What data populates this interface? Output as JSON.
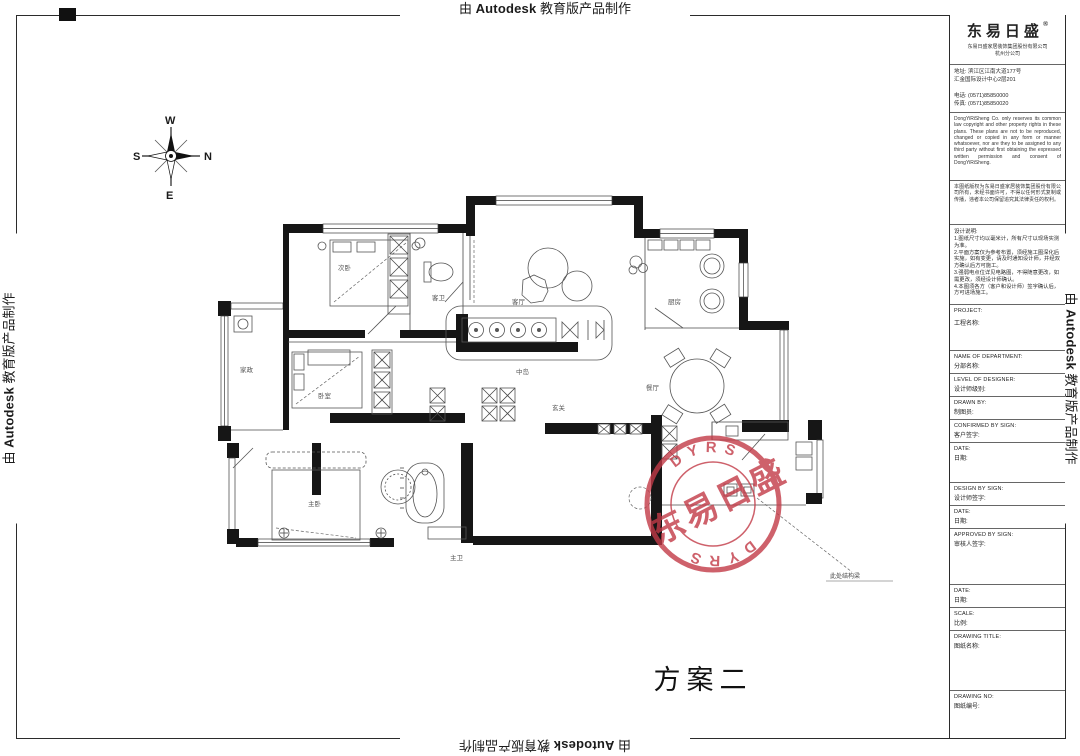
{
  "banner": {
    "prefix": "由 ",
    "brand": "Autodesk",
    "suffix": " 教育版产品制作"
  },
  "sheet_title": "方案二",
  "beam_note": "此处结构梁",
  "compass": {
    "w": "W",
    "n": "N",
    "e": "E",
    "s": "S"
  },
  "stamp": {
    "arc_top": "DYRS",
    "arc_bottom": "DYRS",
    "band": "东易日盛",
    "color": "#c23a47"
  },
  "rooms": {
    "bedroom2": "次卧",
    "bath2": "客卫",
    "living": "客厅",
    "island": "中岛",
    "kitchen": "厨房",
    "dining": "餐厅",
    "foyer": "玄关",
    "bedroom3": "卧室",
    "utility": "家政",
    "master": "主卧",
    "master_bath": "主卫"
  },
  "titleblock": {
    "logo": {
      "name": "东易日盛",
      "reg": "®",
      "company1": "东易日盛家居装饰集团股份有限公司",
      "company2": "杭州分公司"
    },
    "contact": {
      "addr1": "地址: 滨江区江南大道177号",
      "addr2": "汇金国际设计中心2层201",
      "tel": "电话: (0571)85850000",
      "fax": "传真: (0571)85850020"
    },
    "copyright_en": "DongYiRiSheng Co. only reserves its common law copyright and other property rights in these plans. These plans are not to be reproduced, changed or copied in any form or manner whatsoever, nor are they to be assigned to any third party without first obtaining the expressed written permission and consent of DongYiRiSheng.",
    "copyright_cn": "本图纸版权为东易日盛家居装饰集团股份有限公司所有，未经书面许可，不得以任何形式复制或传播，违者本公司保留追究其法律责任的权利。",
    "notes_title": "设计说明:",
    "notes": "1.图纸尺寸均以毫米计，所有尺寸以现场实测为准。\n2.平面方案仅为参考布置，须经施工图深化后实施，如有变更，请及时通知设计师，并经双方确认后方可施工。\n3.强弱电点位详见电路图，不得随意更改，如需更改，须经设计师确认。\n4.本图须各方（客户和设计师）签字确认后，方可进场施工。",
    "fields": {
      "project": {
        "en": "PROJECT:",
        "cn": "工程名称:"
      },
      "department": {
        "en": "NAME OF DEPARTMENT:",
        "cn": "分部名称:"
      },
      "level": {
        "en": "LEVEL OF DESIGNER:",
        "cn": "设计师级别:"
      },
      "drawn": {
        "en": "DRAWN BY:",
        "cn": "制图员:"
      },
      "confirmed": {
        "en": "CONFIRMED BY SIGN:",
        "cn": "客户签字:"
      },
      "date1": {
        "en": "DATE:",
        "cn": "日期:"
      },
      "design": {
        "en": "DESIGN BY SIGN:",
        "cn": "设计师签字:"
      },
      "date2": {
        "en": "DATE:",
        "cn": "日期:"
      },
      "approved": {
        "en": "APPROVED BY SIGN:",
        "cn": "审核人签字:"
      },
      "date3": {
        "en": "DATE:",
        "cn": "日期:"
      },
      "scale": {
        "en": "SCALE:",
        "cn": "比例:"
      },
      "dtitle": {
        "en": "DRAWING TITLE:",
        "cn": "图纸名称:"
      },
      "dno": {
        "en": "DRAWING NO:",
        "cn": "图纸编号:"
      }
    }
  }
}
